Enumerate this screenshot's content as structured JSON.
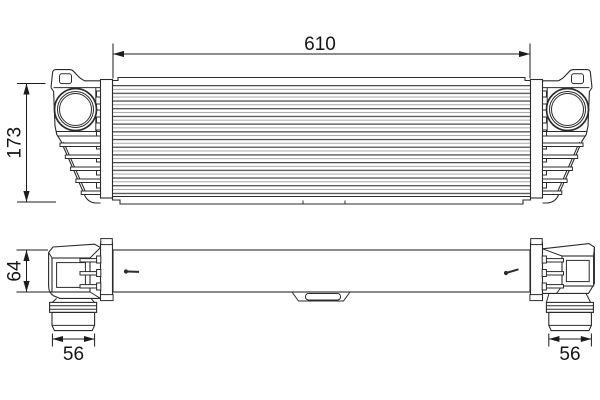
{
  "drawing": {
    "name": "intercooler-technical-drawing",
    "line_color": "#2b2b2b",
    "text_color": "#141414",
    "fin_dark_color": "#4b4b4b",
    "fin_light_color": "#a6a6a6",
    "background": "#ffffff",
    "dimensions": {
      "overall_width": "610",
      "core_height": "173",
      "body_depth": "64",
      "pipe_left_width": "56",
      "pipe_right_width": "56"
    }
  }
}
